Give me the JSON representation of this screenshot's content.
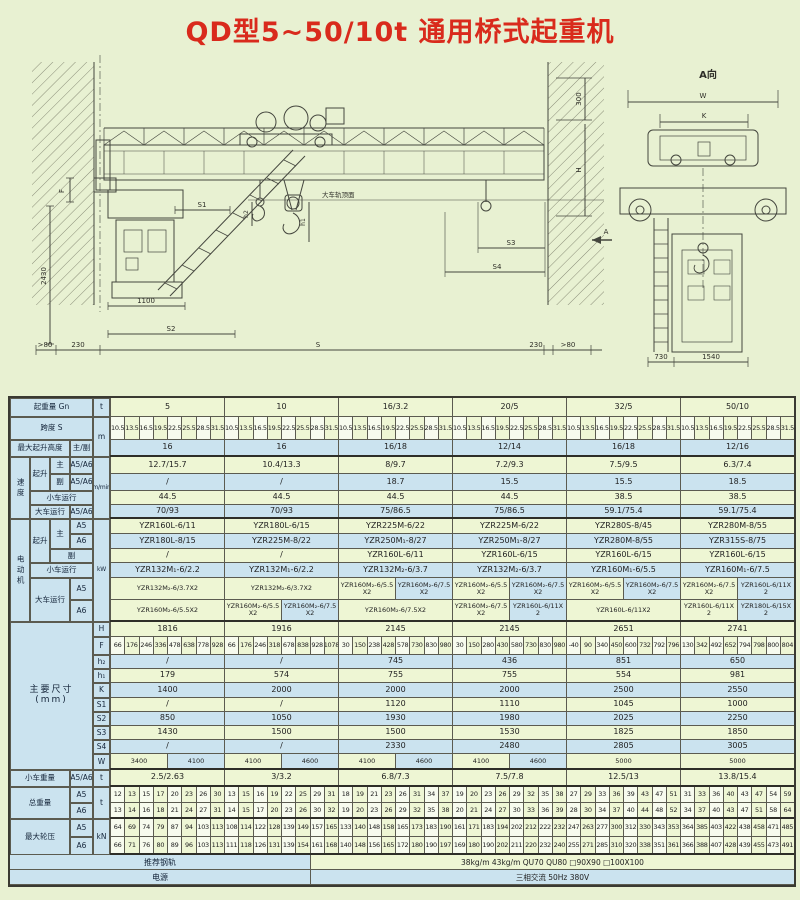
{
  "page": {
    "title": "QD型5~50/10t 通用桥式起重机"
  },
  "drawing": {
    "labels": {
      "F": "F",
      "d2430": "2430",
      "S1": "S1",
      "d1100": "1100",
      "S2": "S2",
      "gt80L": ">80",
      "d230L": "230",
      "S": "S",
      "d230R": "230",
      "gt80R": ">80",
      "d300": "300",
      "H": "H",
      "S3": "S3",
      "S4": "S4",
      "h2": "h2",
      "h1": "h1",
      "rail_top": "大车轨顶面",
      "A": "A",
      "A_view": "A向",
      "W": "W",
      "K": "K",
      "d730": "730",
      "d1540": "1540"
    }
  },
  "table": {
    "row_specs": [
      {
        "key": "capacity",
        "type": "full",
        "h": 19,
        "bg": "g"
      },
      {
        "key": "spans",
        "type": "smalls",
        "h": 23,
        "bg": "g"
      },
      {
        "key": "height",
        "type": "full",
        "h": 17,
        "bg": "b",
        "thick": true
      },
      {
        "key": "speed_main",
        "type": "full",
        "h": 17,
        "bg": "g"
      },
      {
        "key": "speed_aux",
        "type": "full",
        "h": 17,
        "bg": "b"
      },
      {
        "key": "speed_trolley",
        "type": "full",
        "h": 14,
        "bg": "g"
      },
      {
        "key": "speed_crane",
        "type": "full",
        "h": 14,
        "bg": "b",
        "thick": true
      },
      {
        "key": "motor_main_a5",
        "type": "full",
        "h": 15,
        "bg": "g"
      },
      {
        "key": "motor_main_a6",
        "type": "full",
        "h": 15,
        "bg": "b"
      },
      {
        "key": "motor_aux",
        "type": "full",
        "h": 14,
        "bg": "g"
      },
      {
        "key": "motor_trolley",
        "type": "full",
        "h": 15,
        "bg": "b"
      },
      {
        "key": "motor_crane_a5",
        "type": "split",
        "h": 22,
        "bg": "g"
      },
      {
        "key": "motor_crane_a6",
        "type": "split",
        "h": 22,
        "bg": "b",
        "thick": true
      },
      {
        "key": "dim_H",
        "type": "full",
        "h": 15,
        "bg": "g"
      },
      {
        "key": "dim_F",
        "type": "smalls",
        "h": 18,
        "bg": "g"
      },
      {
        "key": "dim_h2",
        "type": "full",
        "h": 14,
        "bg": "b"
      },
      {
        "key": "dim_h1",
        "type": "full",
        "h": 14,
        "bg": "g"
      },
      {
        "key": "dim_K",
        "type": "full",
        "h": 15,
        "bg": "b"
      },
      {
        "key": "dim_S1",
        "type": "full",
        "h": 14,
        "bg": "g"
      },
      {
        "key": "dim_S2",
        "type": "full",
        "h": 14,
        "bg": "b"
      },
      {
        "key": "dim_S3",
        "type": "full",
        "h": 14,
        "bg": "g"
      },
      {
        "key": "dim_S4",
        "type": "full",
        "h": 14,
        "bg": "b"
      },
      {
        "key": "dim_W",
        "type": "split",
        "h": 16,
        "bg": "g",
        "thick": true
      },
      {
        "key": "trolley_weight",
        "type": "full",
        "h": 17,
        "bg": "g",
        "thick": true
      },
      {
        "key": "total_a5",
        "type": "smalls",
        "h": 16,
        "bg": "g"
      },
      {
        "key": "total_a6",
        "type": "smalls",
        "h": 16,
        "bg": "g",
        "thick": true
      },
      {
        "key": "wheel_a5",
        "type": "smalls",
        "h": 18,
        "bg": "g"
      },
      {
        "key": "wheel_a6",
        "type": "smalls",
        "h": 18,
        "bg": "g",
        "thick": true
      },
      {
        "key": "rail",
        "type": "merged",
        "h": 15,
        "bg": "g"
      },
      {
        "key": "power",
        "type": "merged",
        "h": 15,
        "bg": "b"
      }
    ],
    "left_boxes": [
      {
        "x": 0,
        "y": 0,
        "w": 83,
        "h": 19,
        "label": "起重量 Gn"
      },
      {
        "x": 83,
        "y": 0,
        "w": 17,
        "h": 19,
        "label": "t"
      },
      {
        "x": 0,
        "y": 19,
        "w": 83,
        "h": 23,
        "label": "跨度 S"
      },
      {
        "x": 83,
        "y": 19,
        "w": 17,
        "h": 40,
        "label": "m"
      },
      {
        "x": 0,
        "y": 42,
        "w": 60,
        "h": 17,
        "label": "最大起升高度"
      },
      {
        "x": 60,
        "y": 42,
        "w": 23,
        "h": 17,
        "label": "主/副"
      },
      {
        "x": 0,
        "y": 59,
        "w": 20,
        "h": 62,
        "label": "速度",
        "cls": "vert"
      },
      {
        "x": 20,
        "y": 59,
        "w": 20,
        "h": 34,
        "label": "起升"
      },
      {
        "x": 40,
        "y": 59,
        "w": 20,
        "h": 17,
        "label": "主"
      },
      {
        "x": 60,
        "y": 59,
        "w": 23,
        "h": 17,
        "label": "A5/A6"
      },
      {
        "x": 40,
        "y": 76,
        "w": 20,
        "h": 17,
        "label": "副"
      },
      {
        "x": 60,
        "y": 76,
        "w": 23,
        "h": 17,
        "label": "A5/A6"
      },
      {
        "x": 20,
        "y": 93,
        "w": 63,
        "h": 14,
        "label": "小车运行"
      },
      {
        "x": 20,
        "y": 107,
        "w": 40,
        "h": 14,
        "label": "大车运行"
      },
      {
        "x": 60,
        "y": 107,
        "w": 23,
        "h": 14,
        "label": "A5/A6"
      },
      {
        "x": 83,
        "y": 59,
        "w": 17,
        "h": 62,
        "label": "m/min",
        "cls": "u"
      },
      {
        "x": 0,
        "y": 121,
        "w": 20,
        "h": 103,
        "label": "电动机",
        "cls": "vert"
      },
      {
        "x": 20,
        "y": 121,
        "w": 20,
        "h": 44,
        "label": "起升"
      },
      {
        "x": 40,
        "y": 121,
        "w": 20,
        "h": 30,
        "label": "主"
      },
      {
        "x": 60,
        "y": 121,
        "w": 23,
        "h": 15,
        "label": "A5"
      },
      {
        "x": 60,
        "y": 136,
        "w": 23,
        "h": 15,
        "label": "A6"
      },
      {
        "x": 40,
        "y": 151,
        "w": 43,
        "h": 14,
        "label": "副"
      },
      {
        "x": 20,
        "y": 165,
        "w": 63,
        "h": 15,
        "label": "小车运行"
      },
      {
        "x": 20,
        "y": 180,
        "w": 40,
        "h": 44,
        "label": "大车运行"
      },
      {
        "x": 60,
        "y": 180,
        "w": 23,
        "h": 22,
        "label": "A5"
      },
      {
        "x": 60,
        "y": 202,
        "w": 23,
        "h": 22,
        "label": "A6"
      },
      {
        "x": 83,
        "y": 121,
        "w": 17,
        "h": 103,
        "label": "kW",
        "cls": "u"
      },
      {
        "x": 0,
        "y": 224,
        "w": 83,
        "h": 148,
        "label": "主要尺寸\n(mm)",
        "cls": "big"
      },
      {
        "x": 83,
        "y": 224,
        "w": 17,
        "h": 15,
        "label": "H"
      },
      {
        "x": 83,
        "y": 239,
        "w": 17,
        "h": 18,
        "label": "F"
      },
      {
        "x": 83,
        "y": 257,
        "w": 17,
        "h": 14,
        "label": "h₂"
      },
      {
        "x": 83,
        "y": 271,
        "w": 17,
        "h": 14,
        "label": "h₁"
      },
      {
        "x": 83,
        "y": 285,
        "w": 17,
        "h": 15,
        "label": "K"
      },
      {
        "x": 83,
        "y": 300,
        "w": 17,
        "h": 14,
        "label": "S1"
      },
      {
        "x": 83,
        "y": 314,
        "w": 17,
        "h": 14,
        "label": "S2"
      },
      {
        "x": 83,
        "y": 328,
        "w": 17,
        "h": 14,
        "label": "S3"
      },
      {
        "x": 83,
        "y": 342,
        "w": 17,
        "h": 14,
        "label": "S4"
      },
      {
        "x": 83,
        "y": 356,
        "w": 17,
        "h": 16,
        "label": "W"
      },
      {
        "x": 0,
        "y": 372,
        "w": 60,
        "h": 17,
        "label": "小车重量"
      },
      {
        "x": 60,
        "y": 372,
        "w": 23,
        "h": 17,
        "label": "A5/A6"
      },
      {
        "x": 83,
        "y": 372,
        "w": 17,
        "h": 17,
        "label": "t"
      },
      {
        "x": 0,
        "y": 389,
        "w": 60,
        "h": 32,
        "label": "总重量"
      },
      {
        "x": 60,
        "y": 389,
        "w": 23,
        "h": 16,
        "label": "A5"
      },
      {
        "x": 60,
        "y": 405,
        "w": 23,
        "h": 16,
        "label": "A6"
      },
      {
        "x": 83,
        "y": 389,
        "w": 17,
        "h": 32,
        "label": "t"
      },
      {
        "x": 0,
        "y": 421,
        "w": 60,
        "h": 36,
        "label": "最大轮压"
      },
      {
        "x": 60,
        "y": 421,
        "w": 23,
        "h": 18,
        "label": "A5"
      },
      {
        "x": 60,
        "y": 439,
        "w": 23,
        "h": 18,
        "label": "A6"
      },
      {
        "x": 83,
        "y": 421,
        "w": 17,
        "h": 36,
        "label": "kN"
      }
    ],
    "rows": {
      "capacity": [
        "5",
        "10",
        "16/3.2",
        "20/5",
        "32/5",
        "50/10"
      ],
      "spans": [
        [
          "10.5",
          "13.5",
          "16.5",
          "19.5",
          "22.5",
          "25.5",
          "28.5",
          "31.5"
        ],
        [
          "10.5",
          "13.5",
          "16.5",
          "19.5",
          "22.5",
          "25.5",
          "28.5",
          "31.5"
        ],
        [
          "10.5",
          "13.5",
          "16.5",
          "19.5",
          "22.5",
          "25.5",
          "28.5",
          "31.5"
        ],
        [
          "10.5",
          "13.5",
          "16.5",
          "19.5",
          "22.5",
          "25.5",
          "28.5",
          "31.5"
        ],
        [
          "10.5",
          "13.5",
          "16.5",
          "19.5",
          "22.5",
          "25.5",
          "28.5",
          "31.5"
        ],
        [
          "10.5",
          "13.5",
          "16.5",
          "19.5",
          "22.5",
          "25.5",
          "28.5",
          "31.5"
        ]
      ],
      "height": [
        "16",
        "16",
        "16/18",
        "12/14",
        "16/18",
        "12/16"
      ],
      "speed_main": [
        "12.7/15.7",
        "10.4/13.3",
        "8/9.7",
        "7.2/9.3",
        "7.5/9.5",
        "6.3/7.4"
      ],
      "speed_aux": [
        "/",
        "/",
        "18.7",
        "15.5",
        "15.5",
        "18.5"
      ],
      "speed_trolley": [
        "44.5",
        "44.5",
        "44.5",
        "44.5",
        "38.5",
        "38.5"
      ],
      "speed_crane": [
        "70/93",
        "70/93",
        "75/86.5",
        "75/86.5",
        "59.1/75.4",
        "59.1/75.4"
      ],
      "motor_main_a5": [
        "YZR160L-6/11",
        "YZR180L-6/15",
        "YZR225M-6/22",
        "YZR225M-6/22",
        "YZR280S-8/45",
        "YZR280M-8/55"
      ],
      "motor_main_a6": [
        "YZR180L-8/15",
        "YZR225M-8/22",
        "YZR250M₁-8/27",
        "YZR250M₁-8/27",
        "YZR280M-8/55",
        "YZR315S-8/75"
      ],
      "motor_aux": [
        "/",
        "/",
        "YZR160L-6/11",
        "YZR160L-6/15",
        "YZR160L-6/15",
        "YZR160L-6/15"
      ],
      "motor_trolley": [
        "YZR132M₁-6/2.2",
        "YZR132M₁-6/2.2",
        "YZR132M₂-6/3.7",
        "YZR132M₂-6/3.7",
        "YZR160M₁-6/5.5",
        "YZR160M₁-6/7.5"
      ],
      "motor_crane_a5": [
        [
          "YZR132M₂-6/3.7X2"
        ],
        [
          "YZR132M₂-6/3.7X2"
        ],
        [
          "YZR160M₂-6/5.5X2",
          "YZR160M₂-6/7.5X2"
        ],
        [
          "YZR160M₂-6/5.5X2",
          "YZR160M₂-6/7.5X2"
        ],
        [
          "YZR160M₂-6/5.5X2",
          "YZR160M₂-6/7.5X2"
        ],
        [
          "YZR160M₂-6/7.5X2",
          "YZR160L-6/11X2"
        ]
      ],
      "motor_crane_a6": [
        [
          "YZR160M₂-6/5.5X2"
        ],
        [
          "YZR160M₂-6/5.5X2",
          "YZR160M₂-6/7.5X2"
        ],
        [
          "YZR160M₂-6/7.5X2"
        ],
        [
          "YZR160M₂-6/7.5X2",
          "YZR160L-6/11X2"
        ],
        [
          "YZR160L-6/11X2"
        ],
        [
          "YZR160L-6/11X2",
          "YZR180L-6/15X2"
        ]
      ],
      "dim_H": [
        "1816",
        "1916",
        "2145",
        "2145",
        "2651",
        "2741"
      ],
      "dim_F": [
        [
          "66",
          "176",
          "246",
          "336",
          "478",
          "638",
          "778",
          "928"
        ],
        [
          "66",
          "176",
          "246",
          "318",
          "678",
          "838",
          "928",
          "1078"
        ],
        [
          "30",
          "150",
          "238",
          "428",
          "578",
          "730",
          "830",
          "980"
        ],
        [
          "30",
          "150",
          "280",
          "430",
          "580",
          "730",
          "830",
          "980"
        ],
        [
          "-40",
          "90",
          "340",
          "450",
          "600",
          "732",
          "792",
          "796"
        ],
        [
          "130",
          "342",
          "492",
          "652",
          "794",
          "798",
          "800",
          "804"
        ]
      ],
      "dim_h2": [
        "/",
        "/",
        "745",
        "436",
        "851",
        "650"
      ],
      "dim_h1": [
        "179",
        "574",
        "755",
        "755",
        "554",
        "981"
      ],
      "dim_K": [
        "1400",
        "2000",
        "2000",
        "2000",
        "2500",
        "2550"
      ],
      "dim_S1": [
        "/",
        "/",
        "1120",
        "1110",
        "1045",
        "1000"
      ],
      "dim_S2": [
        "850",
        "1050",
        "1930",
        "1980",
        "2025",
        "2250"
      ],
      "dim_S3": [
        "1430",
        "1500",
        "1500",
        "1530",
        "1825",
        "1850"
      ],
      "dim_S4": [
        "/",
        "/",
        "2330",
        "2480",
        "2805",
        "3005"
      ],
      "dim_W": [
        [
          "3400",
          "4100"
        ],
        [
          "4100",
          "4600"
        ],
        [
          "4100",
          "4600"
        ],
        [
          "4100",
          "4600"
        ],
        [
          "5000"
        ],
        [
          "5000"
        ]
      ],
      "trolley_weight": [
        "2.5/2.63",
        "3/3.2",
        "6.8/7.3",
        "7.5/7.8",
        "12.5/13",
        "13.8/15.4"
      ],
      "total_a5": [
        [
          "12",
          "13",
          "15",
          "17",
          "20",
          "23",
          "26",
          "30"
        ],
        [
          "13",
          "15",
          "16",
          "19",
          "22",
          "25",
          "29",
          "31"
        ],
        [
          "18",
          "19",
          "21",
          "23",
          "26",
          "31",
          "34",
          "37"
        ],
        [
          "19",
          "20",
          "23",
          "26",
          "29",
          "32",
          "35",
          "38"
        ],
        [
          "27",
          "29",
          "33",
          "36",
          "39",
          "43",
          "47",
          "51"
        ],
        [
          "31",
          "33",
          "36",
          "40",
          "43",
          "47",
          "54",
          "59"
        ]
      ],
      "total_a6": [
        [
          "13",
          "14",
          "16",
          "18",
          "21",
          "24",
          "27",
          "31"
        ],
        [
          "14",
          "15",
          "17",
          "20",
          "23",
          "26",
          "30",
          "32"
        ],
        [
          "19",
          "20",
          "23",
          "26",
          "29",
          "32",
          "35",
          "38"
        ],
        [
          "20",
          "21",
          "24",
          "27",
          "30",
          "33",
          "36",
          "39"
        ],
        [
          "28",
          "30",
          "34",
          "37",
          "40",
          "44",
          "48",
          "52"
        ],
        [
          "34",
          "37",
          "40",
          "43",
          "47",
          "51",
          "58",
          "64"
        ]
      ],
      "wheel_a5": [
        [
          "64",
          "69",
          "74",
          "79",
          "87",
          "94",
          "103",
          "113"
        ],
        [
          "108",
          "114",
          "122",
          "128",
          "139",
          "149",
          "157",
          "165"
        ],
        [
          "133",
          "140",
          "148",
          "158",
          "165",
          "173",
          "183",
          "190"
        ],
        [
          "161",
          "171",
          "183",
          "194",
          "202",
          "212",
          "222",
          "232"
        ],
        [
          "247",
          "263",
          "277",
          "300",
          "312",
          "330",
          "343",
          "353"
        ],
        [
          "364",
          "385",
          "403",
          "422",
          "438",
          "458",
          "471",
          "485"
        ]
      ],
      "wheel_a6": [
        [
          "66",
          "71",
          "76",
          "80",
          "89",
          "96",
          "103",
          "113"
        ],
        [
          "111",
          "118",
          "126",
          "131",
          "139",
          "154",
          "161",
          "168"
        ],
        [
          "140",
          "148",
          "156",
          "165",
          "172",
          "180",
          "190",
          "197"
        ],
        [
          "169",
          "180",
          "190",
          "202",
          "211",
          "220",
          "232",
          "240"
        ],
        [
          "255",
          "271",
          "285",
          "310",
          "320",
          "338",
          "351",
          "361"
        ],
        [
          "366",
          "388",
          "407",
          "428",
          "439",
          "455",
          "473",
          "491"
        ]
      ],
      "rail": {
        "label": "推荐钢轨",
        "value": "38kg/m  43kg/m  QU70  QU80  □90X90  □100X100"
      },
      "power": {
        "label": "电源",
        "value": "三相交流  50Hz  380V"
      }
    }
  }
}
